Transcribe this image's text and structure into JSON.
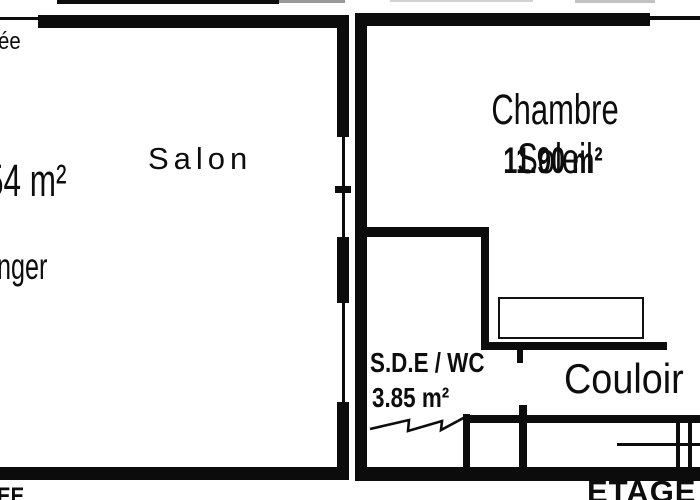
{
  "plan": {
    "colors": {
      "ink": "#0c0c0c",
      "bg": "#ffffff"
    },
    "left_unit": {
      "floor_label_partial": "EE",
      "entree_label_partial": "ée",
      "area_label_partial": "54 m²",
      "dining_label_partial": "nger",
      "salon_label": "Salon"
    },
    "right_unit": {
      "floor_label": "ETAGE",
      "chambre_name": "Chambre Soleil",
      "chambre_area": "11.90 m²",
      "bath_name": "S.D.E / WC",
      "bath_area": "3.85 m²",
      "hall_name": "Couloir"
    }
  }
}
